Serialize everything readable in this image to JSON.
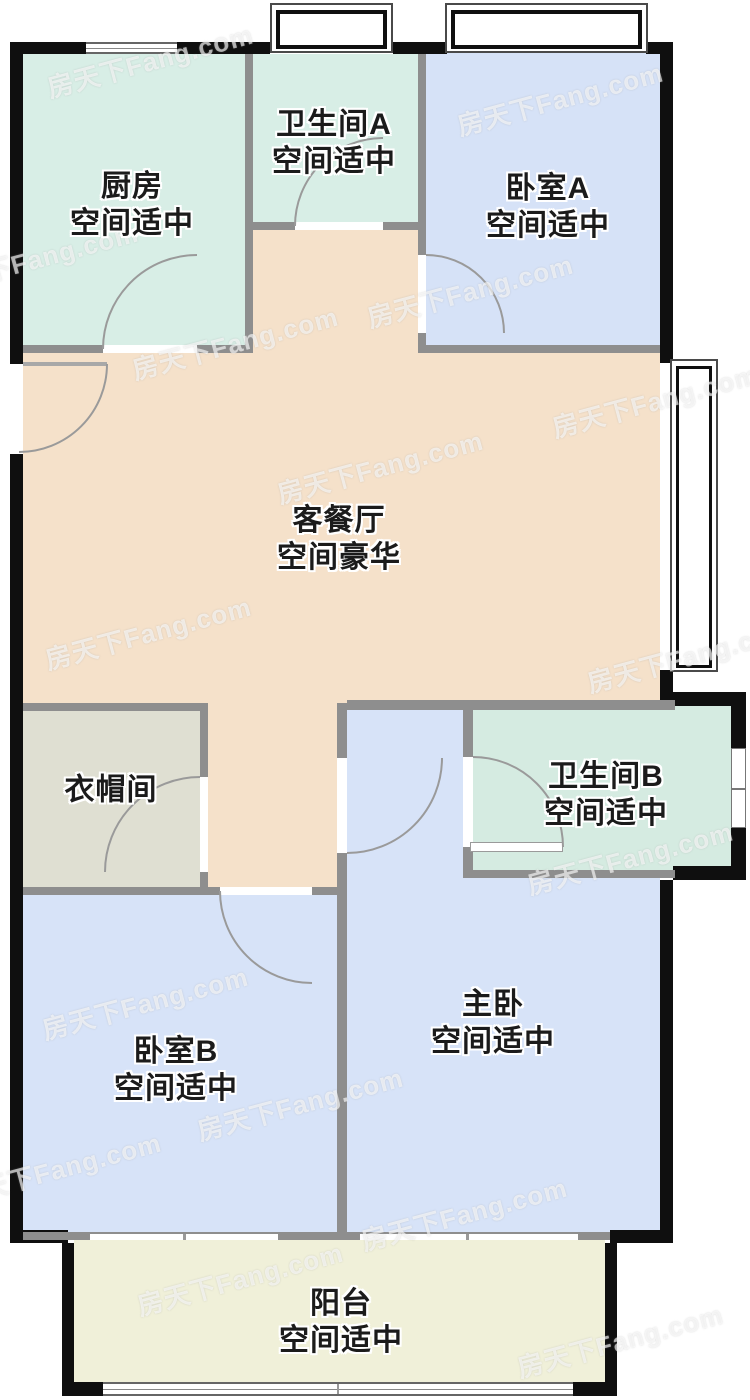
{
  "watermark": {
    "text": "房天下Fang.com"
  },
  "rooms": {
    "kitchen": {
      "name": "厨房",
      "grade": "空间适中"
    },
    "bathroom_a": {
      "name": "卫生间A",
      "grade": "空间适中"
    },
    "bedroom_a": {
      "name": "卧室A",
      "grade": "空间适中"
    },
    "living_dining": {
      "name": "客餐厅",
      "grade": "空间豪华"
    },
    "closet": {
      "name": "衣帽间"
    },
    "bathroom_b": {
      "name": "卫生间B",
      "grade": "空间适中"
    },
    "master_bedroom": {
      "name": "主卧",
      "grade": "空间适中"
    },
    "bedroom_b": {
      "name": "卧室B",
      "grade": "空间适中"
    },
    "balcony": {
      "name": "阳台",
      "grade": "空间适中"
    }
  },
  "colors": {
    "wall_exterior": "#0f0f0f",
    "wall_interior": "#8e8e8e",
    "floor_kitchen": "#d8eee6",
    "floor_bathroom_a": "#d8eee6",
    "floor_bathroom_b": "#d5ebe1",
    "floor_bedroom_a": "#d6e2f7",
    "floor_bedroom_b": "#d7e3f8",
    "floor_master": "#d7e3f8",
    "floor_living": "#f5e1ca",
    "floor_corridor": "#f5e1ca",
    "floor_closet": "#dfdfd2",
    "floor_balcony": "#f0f0d9",
    "door_arc": "#9a9a9a"
  }
}
